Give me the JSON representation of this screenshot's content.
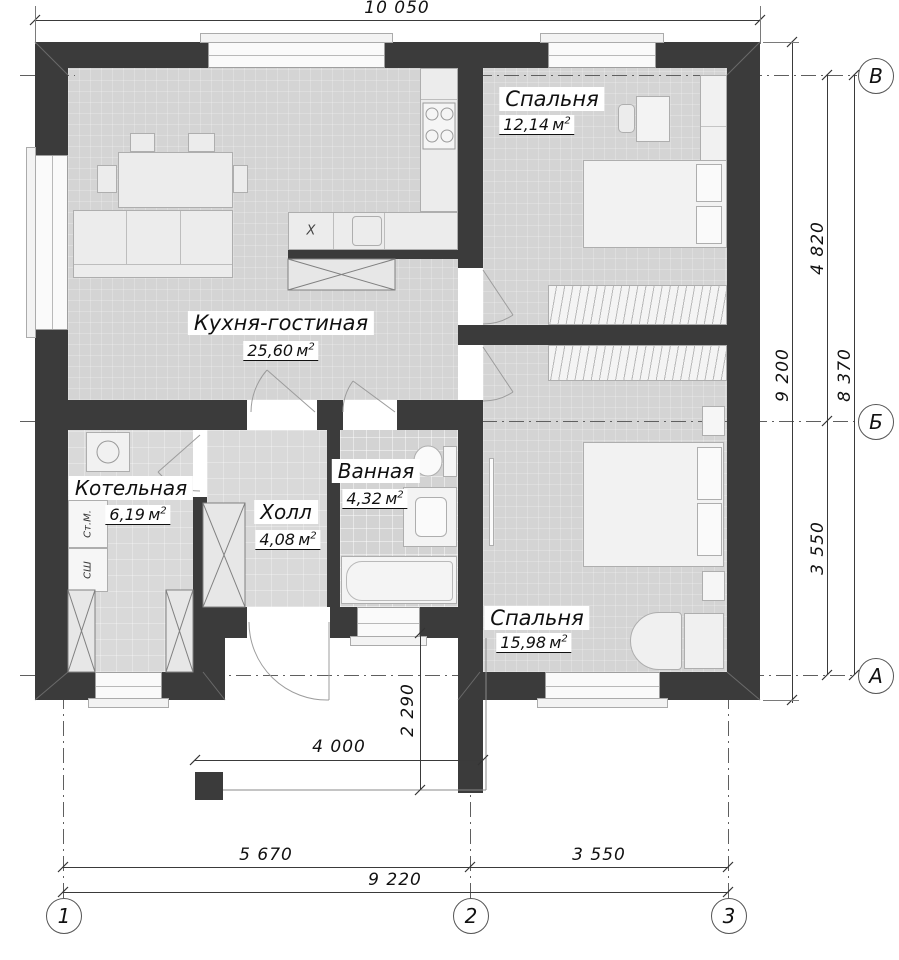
{
  "plan_title": "floor-plan",
  "colors": {
    "wall": "#3b3b3b",
    "floor": "#d6d6d6",
    "paper": "#ffffff"
  },
  "area_unit": {
    "letter": "м",
    "exp": "2"
  },
  "rooms": [
    {
      "name": "Кухня-гостиная",
      "area": "25,60"
    },
    {
      "name": "Спальня",
      "area": "12,14"
    },
    {
      "name": "Котельная",
      "area": "6,19"
    },
    {
      "name": "Холл",
      "area": "4,08"
    },
    {
      "name": "Ванная",
      "area": "4,32"
    },
    {
      "name": "Спальня",
      "area": "15,98"
    }
  ],
  "dimensions": {
    "top_overall": "10 050",
    "right_overall": "9 200",
    "right_grid_total": "8 370",
    "right_v_b": "4 820",
    "right_b_a": "3 550",
    "bottom_1_2": "5 670",
    "bottom_2_3": "3 550",
    "bottom_total": "9 220",
    "porch_width": "4 000",
    "porch_depth": "2 290"
  },
  "grid": {
    "rows": [
      "В",
      "Б",
      "А"
    ],
    "cols": [
      "1",
      "2",
      "3"
    ]
  },
  "appliances": {
    "washer": "Ст.М.",
    "cabinet": "СШ",
    "hood_mark": "X"
  }
}
